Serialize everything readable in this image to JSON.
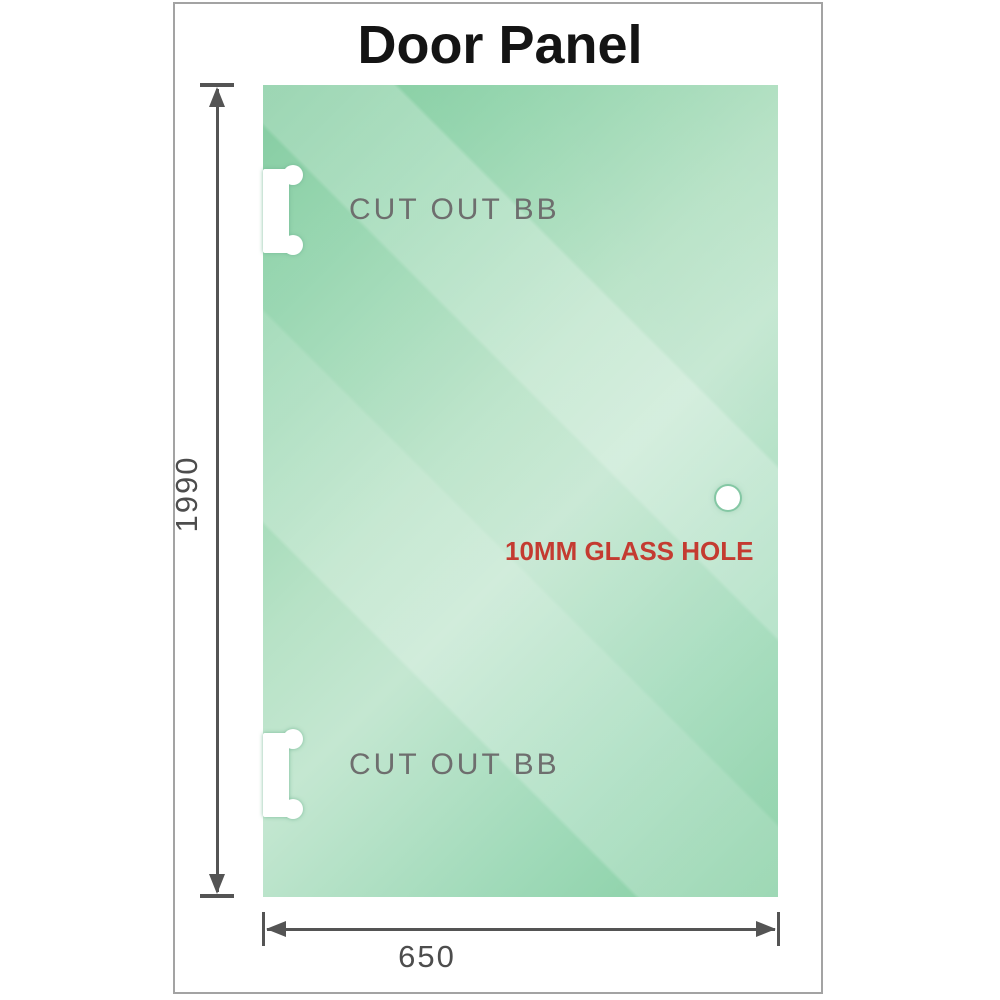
{
  "title": "Door Panel",
  "panel": {
    "cutout_top_label": "CUT OUT BB",
    "cutout_bottom_label": "CUT OUT BB",
    "hole_label": "10MM GLASS HOLE"
  },
  "dimensions": {
    "height": "1990",
    "width": "650"
  },
  "colors": {
    "glass_green_dark": "#7bca9b",
    "glass_green_light": "#c4e7d1",
    "dimension_gray": "#545454",
    "annotation_red": "#c43b31",
    "label_gray": "#6e6e6e",
    "frame_border_gray": "#a3a3a3"
  }
}
